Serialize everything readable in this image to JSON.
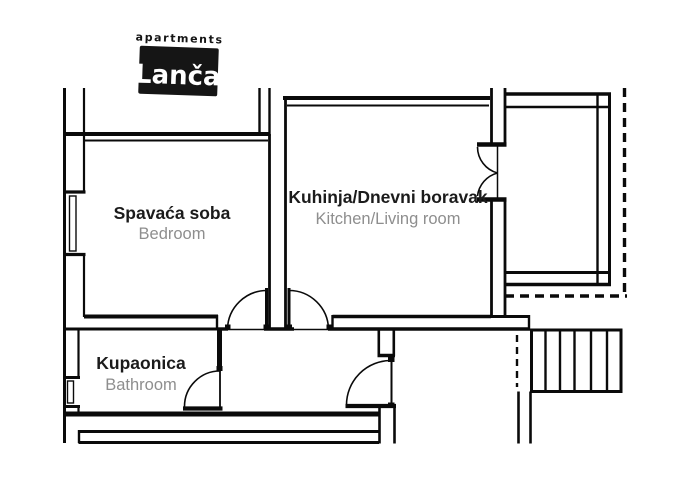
{
  "logo": {
    "brand_top": "apartments",
    "brand_name": "Lanča"
  },
  "rooms": [
    {
      "name_hr": "Spavaća soba",
      "name_en": "Bedroom"
    },
    {
      "name_hr": "Kuhinja/Dnevni boravak",
      "name_en": "Kitchen/Living room"
    },
    {
      "name_hr": "Kupaonica",
      "name_en": "Bathroom"
    }
  ],
  "colors": {
    "line": "#0a0a0a",
    "label_primary": "#1b1b1b",
    "label_secondary": "#8e8e8e",
    "logo_bg": "#151515",
    "logo_text": "#ffffff",
    "background": "#ffffff"
  }
}
